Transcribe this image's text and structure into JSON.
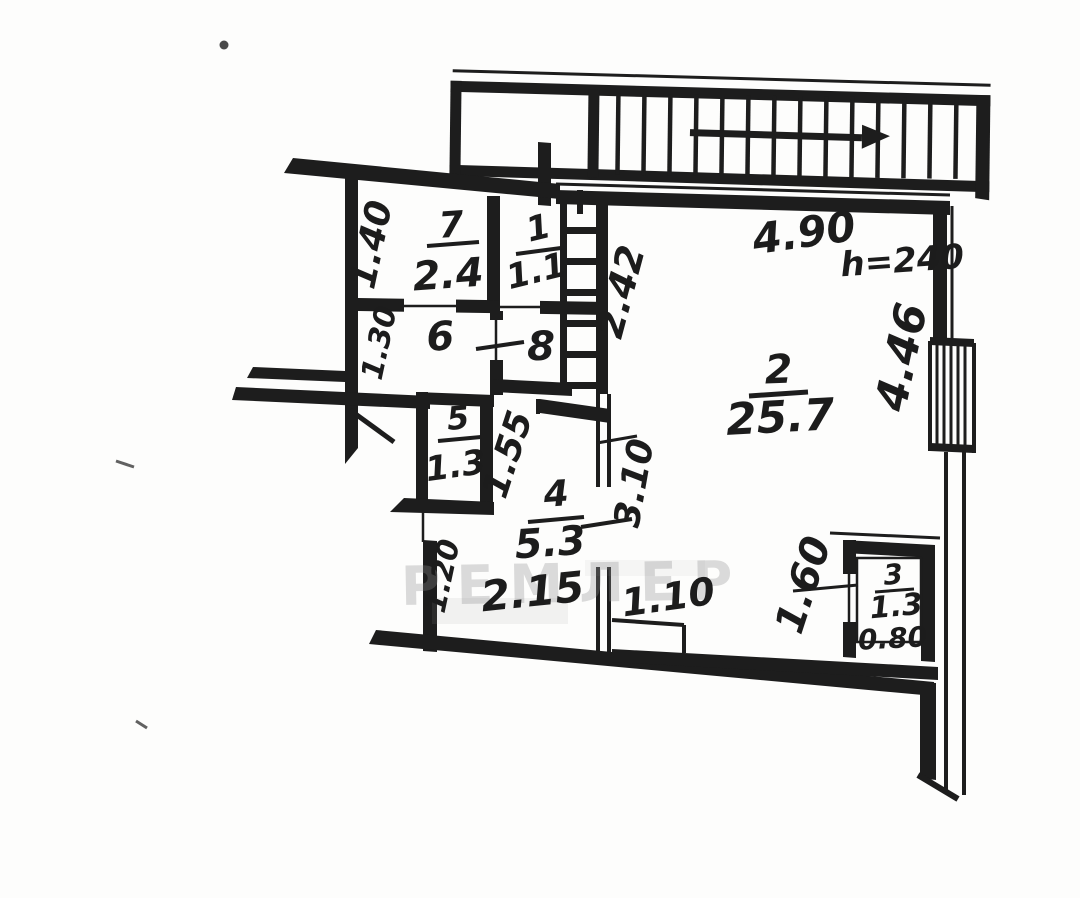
{
  "rooms": [
    {
      "number": "7",
      "area": "2.4"
    },
    {
      "number": "1",
      "area": "1.1"
    },
    {
      "number": "6"
    },
    {
      "number": "8"
    },
    {
      "number": "2",
      "area": "25.7"
    },
    {
      "number": "5",
      "area": "1.3"
    },
    {
      "number": "4",
      "area": "5.3"
    },
    {
      "number": "3",
      "area": "1.3"
    }
  ],
  "dimensions": {
    "room7_width": "1.40",
    "hall_width": "1.30",
    "alcove_depth": "2.42",
    "room2_width": "4.90",
    "ceiling_height": "h=240",
    "room2_depth": "4.46",
    "room4_depth_upper": "1.55",
    "room4_depth": "3.10",
    "room4_lower_width": "1.20",
    "room4_width": "2.15",
    "doorway_width": "1.10",
    "closet_depth": "1.60",
    "closet_width": "0.80"
  },
  "watermark": "РЕМЛЕР",
  "ink_color": "#1d1d1d",
  "paper_color": "#fdfdfc"
}
